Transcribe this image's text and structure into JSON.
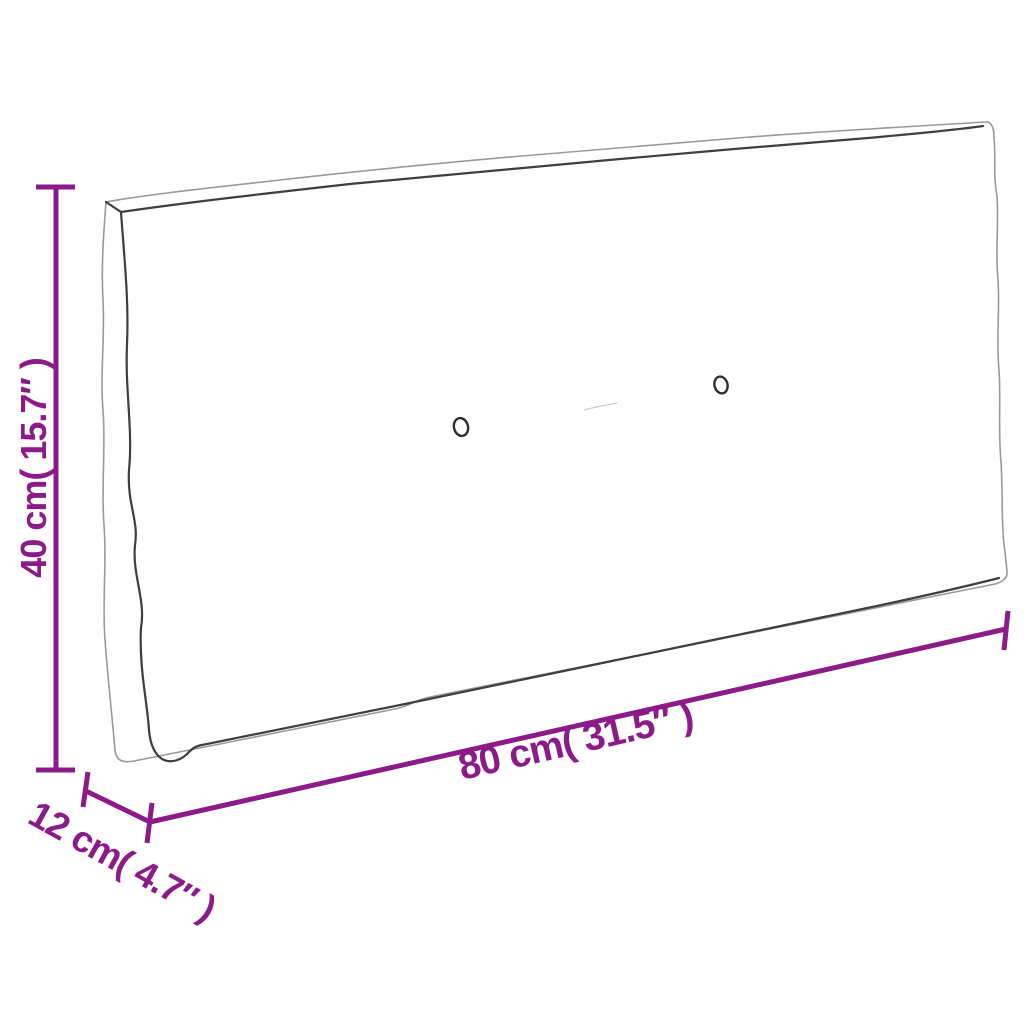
{
  "diagram": {
    "type": "product-dimension-diagram",
    "subject": "pallet-cushion-line-drawing",
    "background_color": "#ffffff",
    "accent_color": "#8C1B89",
    "outline_color": "#9a9a9a",
    "seam_color": "#3f3f3f",
    "labels": {
      "height": "40 cm( 15.7″ )",
      "length": "80 cm( 31.5″ )",
      "depth": "12 cm( 4.7″ )"
    },
    "values": {
      "height_cm": 40,
      "height_in": 15.7,
      "length_cm": 80,
      "length_in": 31.5,
      "depth_cm": 12,
      "depth_in": 4.7
    },
    "button_count": 2
  }
}
